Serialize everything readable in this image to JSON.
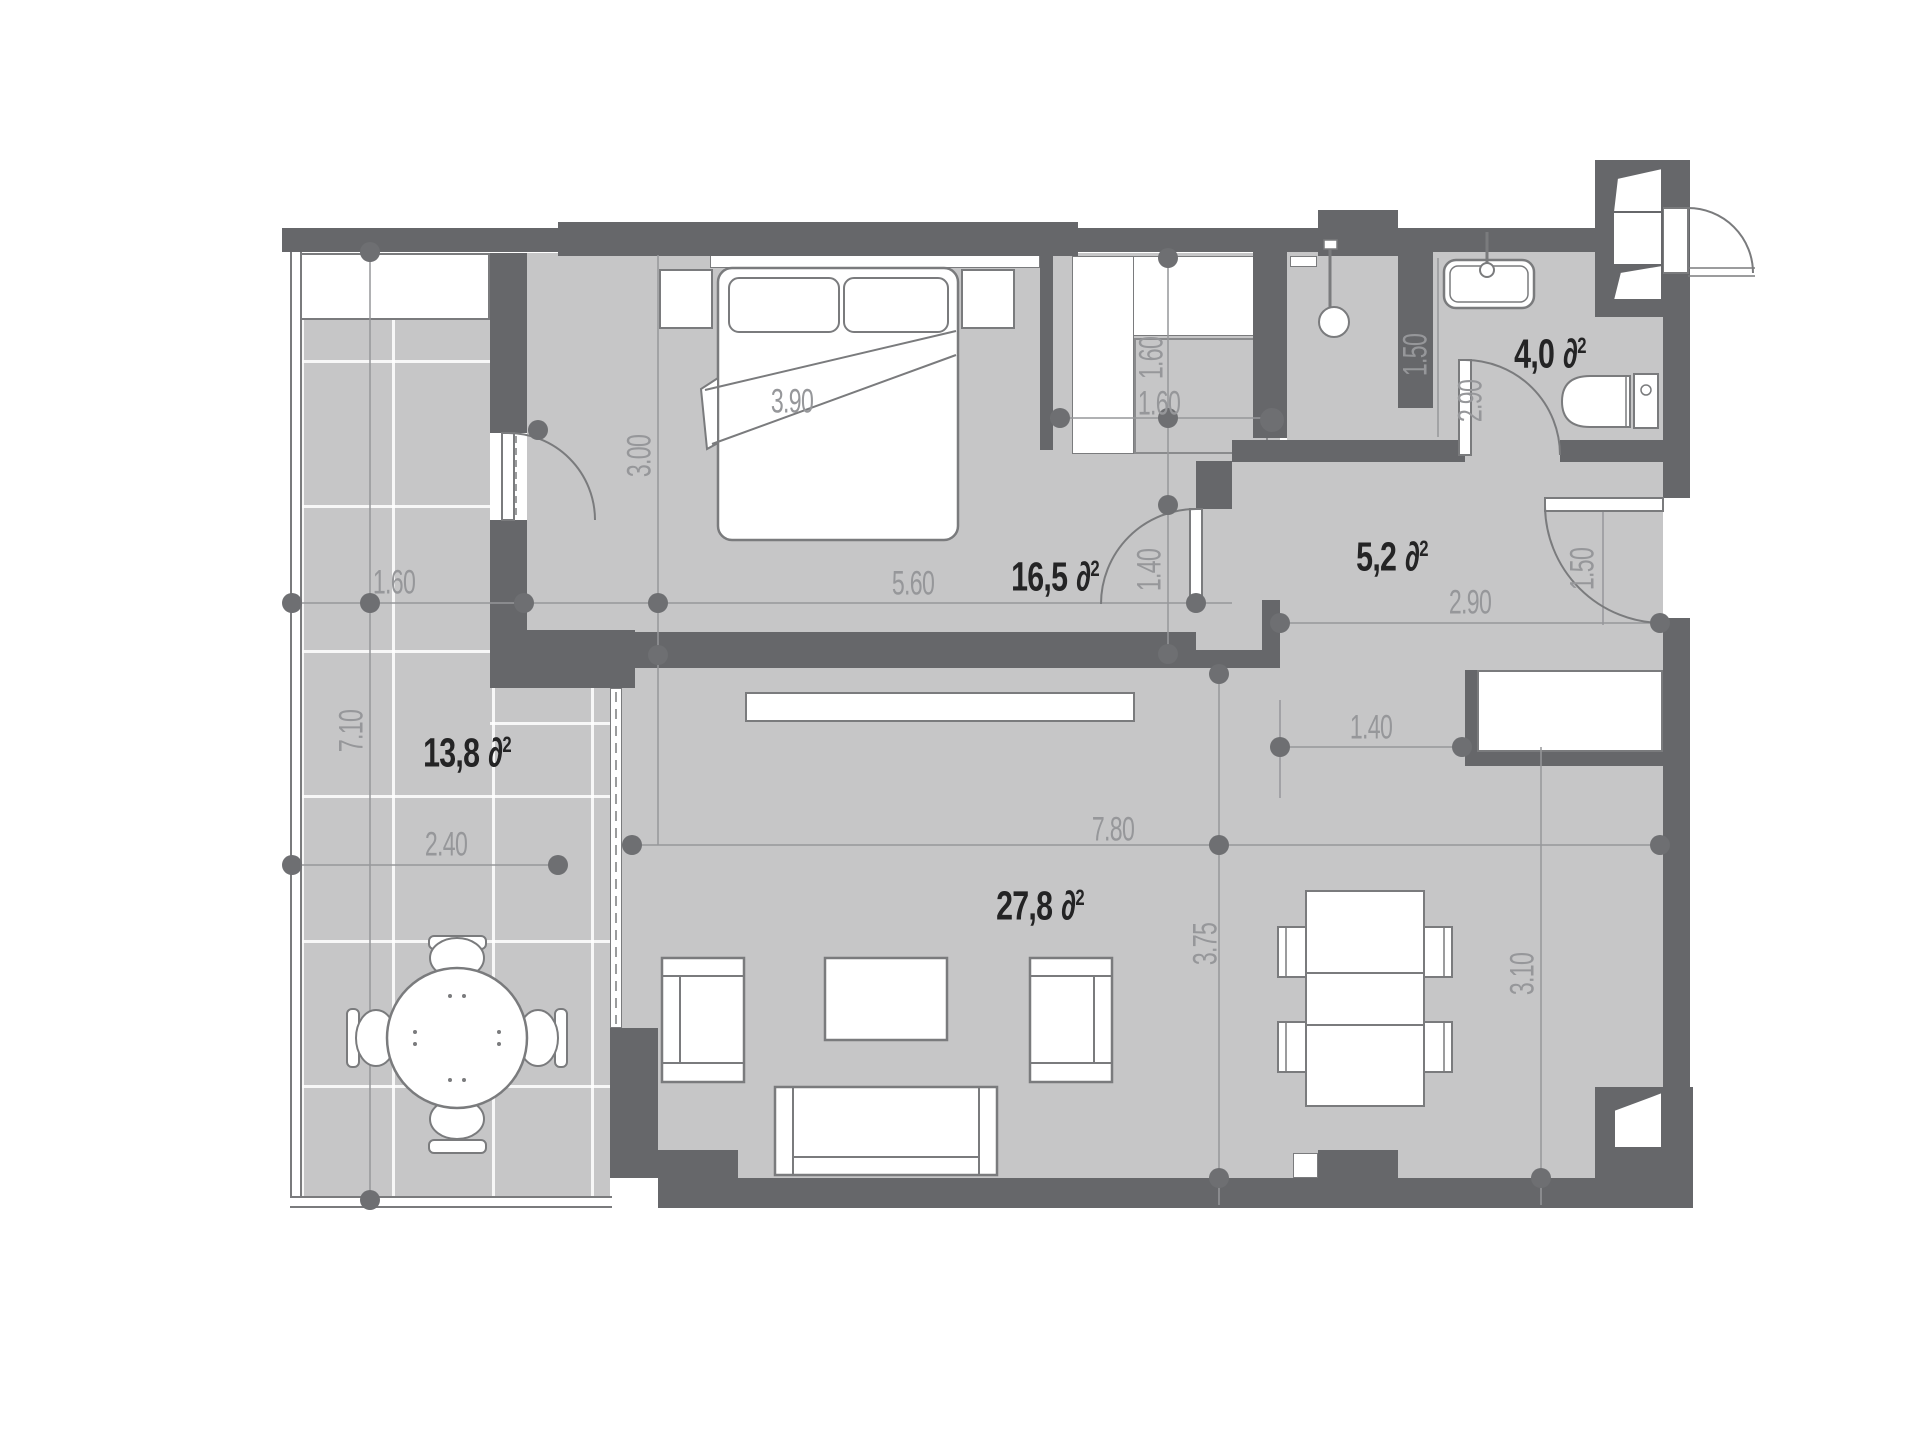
{
  "units": {
    "area_symbol": "∂",
    "area_sup": "2"
  },
  "rooms": {
    "bedroom": {
      "name": "bedroom",
      "area": "16,5"
    },
    "hall": {
      "name": "hall",
      "area": "5,2"
    },
    "bathroom": {
      "name": "bathroom",
      "area": "4,0"
    },
    "balcony": {
      "name": "balcony",
      "area": "13,8"
    },
    "living_room": {
      "name": "living-room",
      "area": "27,8"
    }
  },
  "dimensions": {
    "balcony_top_width": "1.60",
    "balcony_length": "7.10",
    "balcony_width": "2.40",
    "bed_width": "3.90",
    "bedroom_depth": "3.00",
    "bedroom_width": "5.60",
    "bedroom_door_width": "1.40",
    "closet_depth": "1.60",
    "closet_width": "1.60",
    "shower_width": "1.50",
    "bathroom_width": "2.90",
    "hall_width": "2.90",
    "entry_door_width": "1.50",
    "living_width": "7.80",
    "living_depth": "3.75",
    "kitchen_unit_width": "1.40",
    "dining_zone_depth": "3.10"
  },
  "colors": {
    "wall": "#66676a",
    "floor": "#c6c6c7",
    "furniture_stroke": "#7a7b7d",
    "dimension": "#96979a",
    "label": "#242425",
    "background": "#ffffff"
  }
}
